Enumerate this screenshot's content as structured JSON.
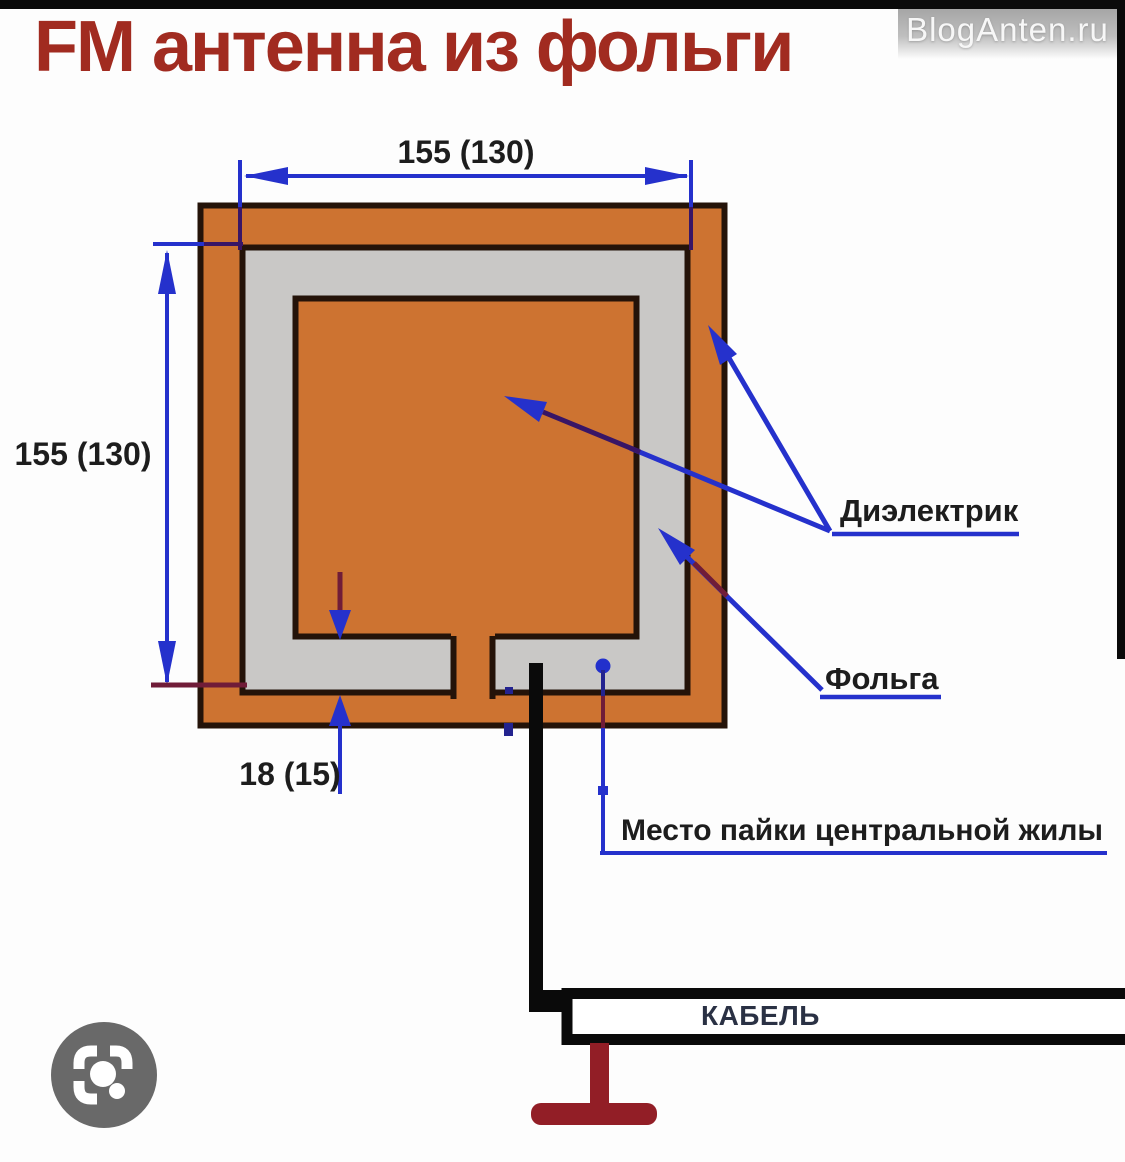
{
  "title": "FM антенна из фольги",
  "watermark": "BlogAnten.ru",
  "diagram": {
    "dim_width": "155 (130)",
    "dim_height": "155 (130)",
    "dim_gap": "18 (15)",
    "label_dielectric": "Диэлектрик",
    "label_foil": "Фольга",
    "label_solder": "Место пайки центральной жилы",
    "label_cable": "КАБЕЛЬ"
  },
  "icons": {
    "lens_icon": "camera-lens-viewfinder"
  },
  "colors": {
    "title_red": "#a12b20",
    "board_orange": "#cd7331",
    "foil_gray": "#c9c8c6",
    "outline_dark": "#241309",
    "dimension_blue": "#2531cc",
    "dot_blue": "#2230cc",
    "dark_blue": "#23238f",
    "overlap_maroon": "#701c38",
    "overlap_purple": "#381566",
    "cable_black": "#0a0a0a",
    "connector_red": "#921e26",
    "lens_gray": "#696969",
    "cable_text": "#2a3144",
    "label_black": "#1d1d1d"
  }
}
